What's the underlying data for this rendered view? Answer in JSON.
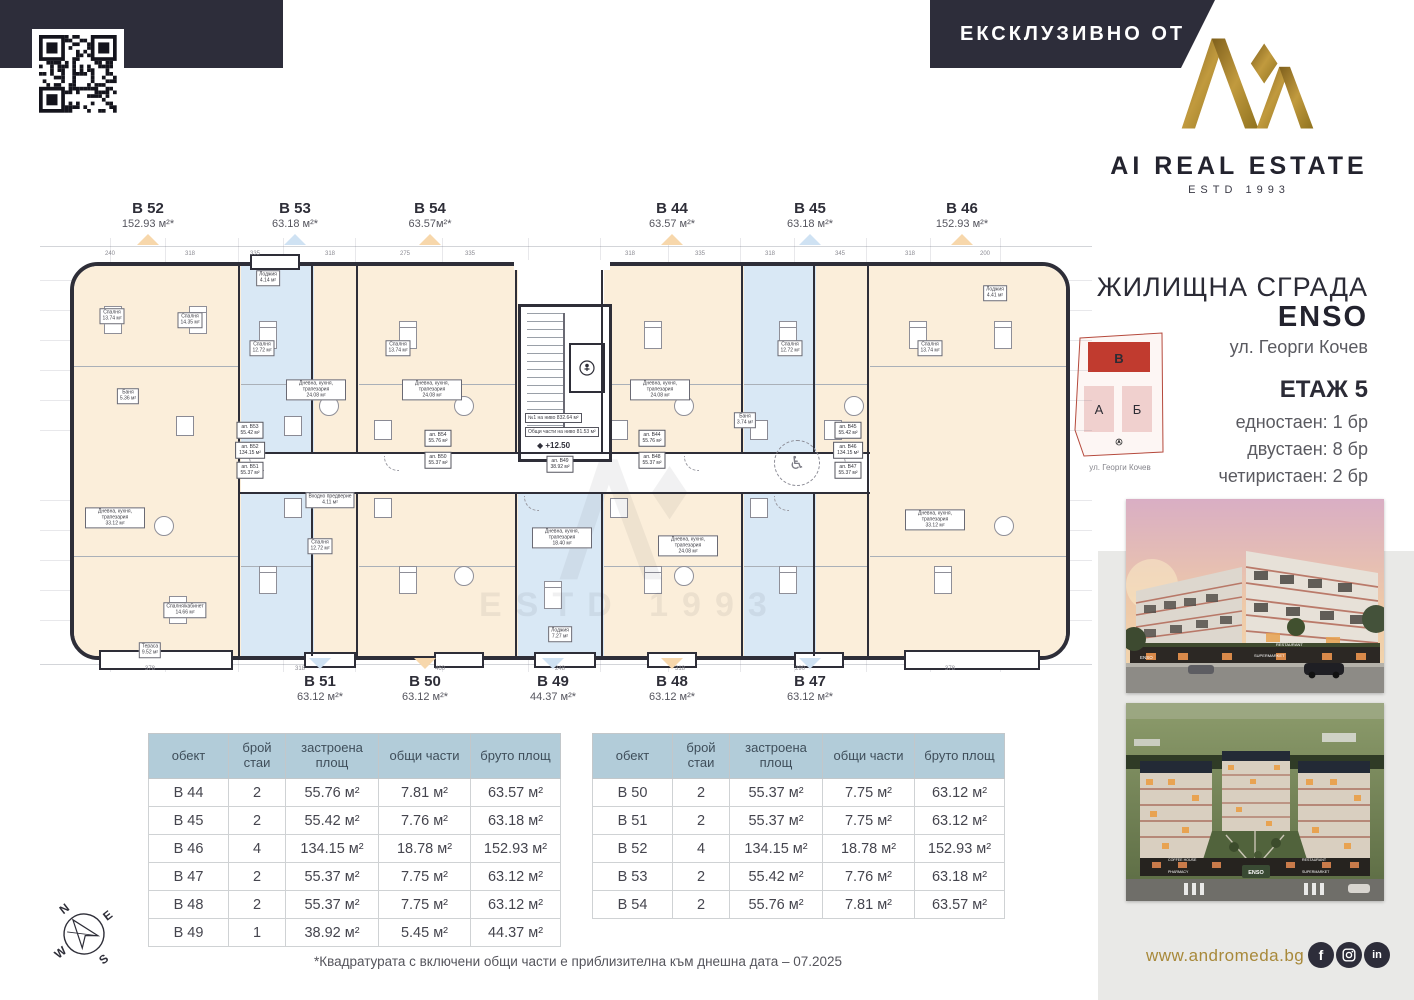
{
  "brand": {
    "exclusive_banner": "ЕКСКЛУЗИВНО ОТ",
    "logo_name": "AI REAL ESTATE",
    "logo_estd": "ESTD 1993",
    "colors": {
      "navy": "#2d2d3a",
      "gold": "#a8893a"
    }
  },
  "project": {
    "title": "ЖИЛИЩНА СГРАДА",
    "name": "ENSO",
    "address": "ул. Георги Кочев",
    "floor": "ЕТАЖ 5",
    "mix": [
      "едностаен: 1 бр",
      "двустаен: 8 бр",
      "четиристаен: 2 бр"
    ],
    "siteplan": {
      "blocks": [
        {
          "label": "В",
          "state": "highlighted",
          "color": "#c13b2f"
        },
        {
          "label": "А",
          "state": "normal",
          "color": "#f0d0ce"
        },
        {
          "label": "Б",
          "state": "normal",
          "color": "#f0d0ce"
        }
      ],
      "street": "ул. Георги Кочев"
    }
  },
  "plan": {
    "units_top": [
      {
        "id": "B 52",
        "area": "152.93 м²*",
        "accent": "#f7d7ab"
      },
      {
        "id": "B 53",
        "area": "63.18 м²*",
        "accent": "#cfe2f3"
      },
      {
        "id": "B 54",
        "area": "63.57м²*",
        "accent": "#f7d7ab"
      },
      {
        "id": "B 44",
        "area": "63.57 м²*",
        "accent": "#f7d7ab"
      },
      {
        "id": "B 45",
        "area": "63.18 м²*",
        "accent": "#cfe2f3"
      },
      {
        "id": "B 46",
        "area": "152.93 м²*",
        "accent": "#f7d7ab"
      }
    ],
    "units_bottom": [
      {
        "id": "B 51",
        "area": "63.12 м²*",
        "accent": "#cfe2f3"
      },
      {
        "id": "B 50",
        "area": "63.12 м²*",
        "accent": "#f7d7ab"
      },
      {
        "id": "B 49",
        "area": "44.37 м²*",
        "accent": "#cfe2f3"
      },
      {
        "id": "B 48",
        "area": "63.12 м²*",
        "accent": "#f7d7ab"
      },
      {
        "id": "B 47",
        "area": "63.12 м²*",
        "accent": "#cfe2f3"
      }
    ],
    "core": {
      "note1": "№1 на ниво 832.64 м²",
      "note2": "Общи части на ниво 81.53 м²",
      "level": "◆ +12.50"
    },
    "watermark": "ESTD 1993",
    "corridor_plates": [
      {
        "id": "ап. B53",
        "area": "55.42 м²"
      },
      {
        "id": "ап. B52",
        "area": "134.15 м²"
      },
      {
        "id": "ап. B51",
        "area": "55.37 м²"
      },
      {
        "id": "ап. B54",
        "area": "55.76 м²"
      },
      {
        "id": "ап. B50",
        "area": "55.37 м²"
      },
      {
        "id": "ап. B49",
        "area": "38.92 м²"
      },
      {
        "id": "ап. B44",
        "area": "55.76 м²"
      },
      {
        "id": "ап. B48",
        "area": "55.37 м²"
      },
      {
        "id": "ап. B45",
        "area": "55.42 м²"
      },
      {
        "id": "ап. B46",
        "area": "134.15 м²"
      },
      {
        "id": "ап. B47",
        "area": "55.37 м²"
      }
    ],
    "room_labels": [
      {
        "name": "Спалня",
        "area": "13.74 м²"
      },
      {
        "name": "Спалня",
        "area": "14.35 м²"
      },
      {
        "name": "Баня",
        "area": "5.36 м²"
      },
      {
        "name": "Спалня",
        "area": "12.72 м²"
      },
      {
        "name": "Дневна, кухня, трапезария",
        "area": "24.08 м²"
      },
      {
        "name": "Спалня",
        "area": "13.74 м²"
      },
      {
        "name": "Дневна, кухня, трапезария",
        "area": "24.08 м²"
      },
      {
        "name": "Дневна, кухня, трапезария",
        "area": "24.08 м²"
      },
      {
        "name": "Спалня",
        "area": "12.72 м²"
      },
      {
        "name": "Спалня",
        "area": "13.74 м²"
      },
      {
        "name": "Дневна, кухня, трапезария",
        "area": "33.12 м²"
      },
      {
        "name": "Спалня",
        "area": "12.72 м²"
      },
      {
        "name": "Дневна, кухня, трапезария",
        "area": "18.40 м²"
      },
      {
        "name": "Дневна, кухня, трапезария",
        "area": "24.08 м²"
      },
      {
        "name": "Дневна, кухня, трапезария",
        "area": "33.12 м²"
      },
      {
        "name": "Спалня/кабинет",
        "area": "14.66 м²"
      },
      {
        "name": "Тераса",
        "area": "9.52 м²"
      },
      {
        "name": "Лоджия",
        "area": "4.14 м²"
      },
      {
        "name": "Лоджия",
        "area": "4.41 м²"
      },
      {
        "name": "Лоджия",
        "area": "7.27 м²"
      },
      {
        "name": "Входно предверие",
        "area": "4.11 м²"
      },
      {
        "name": "Баня",
        "area": "3.74 м²"
      }
    ],
    "dims_top": [
      "240",
      "318",
      "335",
      "318",
      "275",
      "335",
      "318",
      "335",
      "318",
      "345",
      "318",
      "200"
    ],
    "dims_bottom": [
      "378",
      "318",
      "460",
      "248",
      "318",
      "290",
      "378"
    ]
  },
  "tables": {
    "headers": [
      "обект",
      "брой стаи",
      "застроена площ",
      "общи части",
      "бруто площ"
    ],
    "left_rows": [
      [
        "B 44",
        "2",
        "55.76 м²",
        "7.81 м²",
        "63.57 м²"
      ],
      [
        "B 45",
        "2",
        "55.42 м²",
        "7.76 м²",
        "63.18 м²"
      ],
      [
        "B 46",
        "4",
        "134.15 м²",
        "18.78 м²",
        "152.93 м²"
      ],
      [
        "B 47",
        "2",
        "55.37 м²",
        "7.75 м²",
        "63.12 м²"
      ],
      [
        "B 48",
        "2",
        "55.37 м²",
        "7.75 м²",
        "63.12 м²"
      ],
      [
        "B 49",
        "1",
        "38.92 м²",
        "5.45 м²",
        "44.37 м²"
      ]
    ],
    "right_rows": [
      [
        "B 50",
        "2",
        "55.37 м²",
        "7.75 м²",
        "63.12 м²"
      ],
      [
        "B 51",
        "2",
        "55.37 м²",
        "7.75 м²",
        "63.12 м²"
      ],
      [
        "B 52",
        "4",
        "134.15 м²",
        "18.78 м²",
        "152.93 м²"
      ],
      [
        "B 53",
        "2",
        "55.42 м²",
        "7.76 м²",
        "63.18 м²"
      ],
      [
        "B 54",
        "2",
        "55.76 м²",
        "7.81 м²",
        "63.57 м²"
      ]
    ]
  },
  "footnote": "*Квадратурата с включени общи части е приблизителна към днешна дата – 07.2025",
  "footer": {
    "website": "www.andromeda.bg",
    "socials": [
      "facebook",
      "instagram",
      "linkedin"
    ]
  },
  "renders": {
    "photo1_signs": [
      "RESTAURANT",
      "SUPERMARKET",
      "ENSO"
    ],
    "photo2_signs": [
      "COFFEE HOUSE",
      "RESTAURANT",
      "PHARMACY",
      "SUPERMARKET",
      "ENSO"
    ]
  },
  "compass": {
    "n": "N",
    "e": "E",
    "s": "S",
    "w": "W"
  }
}
